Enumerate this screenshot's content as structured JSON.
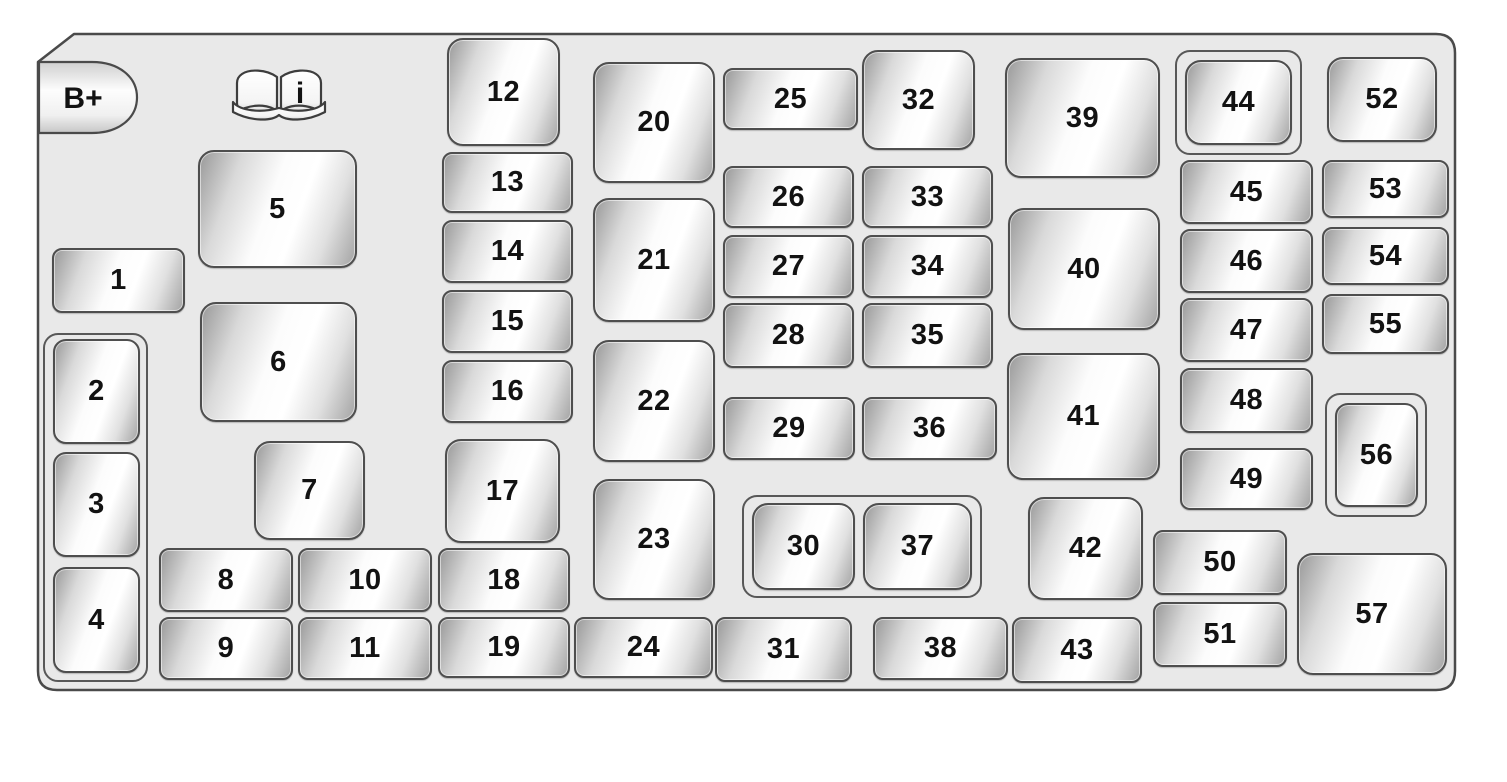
{
  "panel": {
    "battery_label": "B+",
    "manual_icon_label": "i",
    "manual_icon": "open-book-info-icon",
    "colors": {
      "page_background": "#ffffff",
      "panel_fill": "#e9e9e9",
      "outline": "#4a4a4a",
      "fuse_edge_gray": "#9b9b9b",
      "fuse_highlight": "#ffffff",
      "label_color": "#121212"
    },
    "fuses": [
      {
        "label": "1",
        "x": 52,
        "y": 248,
        "w": 133,
        "h": 65
      },
      {
        "label": "2",
        "x": 53,
        "y": 339,
        "w": 87,
        "h": 105
      },
      {
        "label": "3",
        "x": 53,
        "y": 452,
        "w": 87,
        "h": 105
      },
      {
        "label": "4",
        "x": 53,
        "y": 567,
        "w": 87,
        "h": 106
      },
      {
        "label": "5",
        "x": 198,
        "y": 150,
        "w": 159,
        "h": 118
      },
      {
        "label": "6",
        "x": 200,
        "y": 302,
        "w": 157,
        "h": 120
      },
      {
        "label": "7",
        "x": 254,
        "y": 441,
        "w": 111,
        "h": 99
      },
      {
        "label": "8",
        "x": 159,
        "y": 548,
        "w": 134,
        "h": 64
      },
      {
        "label": "9",
        "x": 159,
        "y": 617,
        "w": 134,
        "h": 63
      },
      {
        "label": "10",
        "x": 298,
        "y": 548,
        "w": 134,
        "h": 64
      },
      {
        "label": "11",
        "x": 298,
        "y": 617,
        "w": 134,
        "h": 63
      },
      {
        "label": "12",
        "x": 447,
        "y": 38,
        "w": 113,
        "h": 108
      },
      {
        "label": "13",
        "x": 442,
        "y": 152,
        "w": 131,
        "h": 61
      },
      {
        "label": "14",
        "x": 442,
        "y": 220,
        "w": 131,
        "h": 63
      },
      {
        "label": "15",
        "x": 442,
        "y": 290,
        "w": 131,
        "h": 63
      },
      {
        "label": "16",
        "x": 442,
        "y": 360,
        "w": 131,
        "h": 63
      },
      {
        "label": "17",
        "x": 445,
        "y": 439,
        "w": 115,
        "h": 104
      },
      {
        "label": "18",
        "x": 438,
        "y": 548,
        "w": 132,
        "h": 64
      },
      {
        "label": "19",
        "x": 438,
        "y": 617,
        "w": 132,
        "h": 61
      },
      {
        "label": "20",
        "x": 593,
        "y": 62,
        "w": 122,
        "h": 121
      },
      {
        "label": "21",
        "x": 593,
        "y": 198,
        "w": 122,
        "h": 124
      },
      {
        "label": "22",
        "x": 593,
        "y": 340,
        "w": 122,
        "h": 122
      },
      {
        "label": "23",
        "x": 593,
        "y": 479,
        "w": 122,
        "h": 121
      },
      {
        "label": "24",
        "x": 574,
        "y": 617,
        "w": 139,
        "h": 61
      },
      {
        "label": "25",
        "x": 723,
        "y": 68,
        "w": 135,
        "h": 62
      },
      {
        "label": "26",
        "x": 723,
        "y": 166,
        "w": 131,
        "h": 62
      },
      {
        "label": "27",
        "x": 723,
        "y": 235,
        "w": 131,
        "h": 63
      },
      {
        "label": "28",
        "x": 723,
        "y": 303,
        "w": 131,
        "h": 65
      },
      {
        "label": "29",
        "x": 723,
        "y": 397,
        "w": 132,
        "h": 63
      },
      {
        "label": "30",
        "x": 752,
        "y": 503,
        "w": 103,
        "h": 87
      },
      {
        "label": "31",
        "x": 715,
        "y": 617,
        "w": 137,
        "h": 65
      },
      {
        "label": "32",
        "x": 862,
        "y": 50,
        "w": 113,
        "h": 100
      },
      {
        "label": "33",
        "x": 862,
        "y": 166,
        "w": 131,
        "h": 62
      },
      {
        "label": "34",
        "x": 862,
        "y": 235,
        "w": 131,
        "h": 63
      },
      {
        "label": "35",
        "x": 862,
        "y": 303,
        "w": 131,
        "h": 65
      },
      {
        "label": "36",
        "x": 862,
        "y": 397,
        "w": 135,
        "h": 63
      },
      {
        "label": "37",
        "x": 863,
        "y": 503,
        "w": 109,
        "h": 87
      },
      {
        "label": "38",
        "x": 873,
        "y": 617,
        "w": 135,
        "h": 63
      },
      {
        "label": "39",
        "x": 1005,
        "y": 58,
        "w": 155,
        "h": 120
      },
      {
        "label": "40",
        "x": 1008,
        "y": 208,
        "w": 152,
        "h": 122
      },
      {
        "label": "41",
        "x": 1007,
        "y": 353,
        "w": 153,
        "h": 127
      },
      {
        "label": "42",
        "x": 1028,
        "y": 497,
        "w": 115,
        "h": 103
      },
      {
        "label": "43",
        "x": 1012,
        "y": 617,
        "w": 130,
        "h": 66
      },
      {
        "label": "44",
        "x": 1185,
        "y": 60,
        "w": 107,
        "h": 85
      },
      {
        "label": "45",
        "x": 1180,
        "y": 160,
        "w": 133,
        "h": 64
      },
      {
        "label": "46",
        "x": 1180,
        "y": 229,
        "w": 133,
        "h": 64
      },
      {
        "label": "47",
        "x": 1180,
        "y": 298,
        "w": 133,
        "h": 64
      },
      {
        "label": "48",
        "x": 1180,
        "y": 368,
        "w": 133,
        "h": 65
      },
      {
        "label": "49",
        "x": 1180,
        "y": 448,
        "w": 133,
        "h": 62
      },
      {
        "label": "50",
        "x": 1153,
        "y": 530,
        "w": 134,
        "h": 65
      },
      {
        "label": "51",
        "x": 1153,
        "y": 602,
        "w": 134,
        "h": 65
      },
      {
        "label": "52",
        "x": 1327,
        "y": 57,
        "w": 110,
        "h": 85
      },
      {
        "label": "53",
        "x": 1322,
        "y": 160,
        "w": 127,
        "h": 58
      },
      {
        "label": "54",
        "x": 1322,
        "y": 227,
        "w": 127,
        "h": 58
      },
      {
        "label": "55",
        "x": 1322,
        "y": 294,
        "w": 127,
        "h": 60
      },
      {
        "label": "56",
        "x": 1335,
        "y": 403,
        "w": 83,
        "h": 104
      },
      {
        "label": "57",
        "x": 1297,
        "y": 553,
        "w": 150,
        "h": 122
      }
    ],
    "groups": [
      {
        "name": "fuse-group-2-3-4",
        "x": 43,
        "y": 333,
        "w": 105,
        "h": 349
      },
      {
        "name": "fuse-group-30-37",
        "x": 742,
        "y": 495,
        "w": 240,
        "h": 103
      },
      {
        "name": "fuse-group-44",
        "x": 1175,
        "y": 50,
        "w": 127,
        "h": 105
      },
      {
        "name": "fuse-group-56",
        "x": 1325,
        "y": 393,
        "w": 102,
        "h": 124
      }
    ]
  }
}
